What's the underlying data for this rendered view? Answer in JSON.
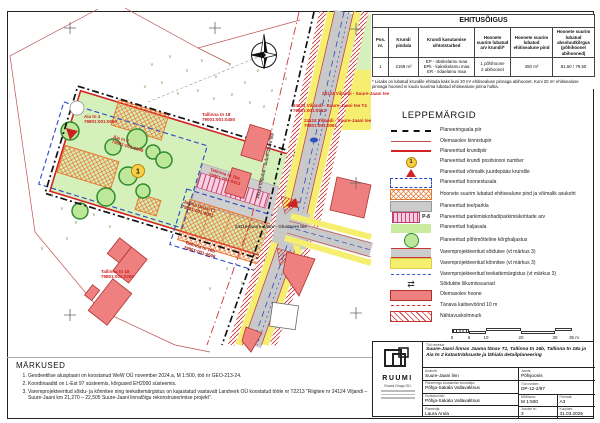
{
  "ehitusoigus": {
    "title": "EHITUSÕIGUS",
    "headers": [
      "Pos. nr.",
      "Krundi pindala",
      "Krundi kasutamise sihtotstarbed",
      "Hoonete suurim lubatud arv krundil*",
      "Hoonete suurim lubatud ehitisealune pind",
      "Hoonete suurim lubatud absoluutkõrgus (põhihoone/ abihooned)"
    ],
    "row": {
      "pos": "1",
      "area": "2169 m²",
      "purpose": "EP - üksikelamu maa\nEPk - kaksikelamu maa\nER - ridaelamu maa",
      "count": "1 põhihoone\n2 abihoonet",
      "footprint": "450 m²",
      "height": "81,50 / 79,50"
    },
    "footnote": "* Lisaks on lubatud krundile ehitada kaks kuni 20 m² ehitisealuse pinnaga abihoonet. Kuni 20 m² ehitisealuse pinnaga hooned ei kuulu suurima lubatud ehitisealuse pinna hulka."
  },
  "legend": {
    "title": "LEPPEMÄRGID",
    "items": [
      {
        "label": "Planeeringuala piir"
      },
      {
        "label": "Olemasolev kinnistupiir"
      },
      {
        "label": "Planeeritud krundipiir"
      },
      {
        "label": "Planeeritud krundi positsiooni number",
        "glyph": "1"
      },
      {
        "label": "Planeeritud võimalik juurdepääs krundile"
      },
      {
        "label": "Planeeritud hoonestusala"
      },
      {
        "label": "Hoonete suurim lubatud ehitisealune pind ja võimalik asukoht"
      },
      {
        "label": "Planeeritud tee/parkla"
      },
      {
        "label": "Planeeritud parkimiskohad/parkimiskohtade arv",
        "glyph": "P-8"
      },
      {
        "label": "Planeeritud haljasala"
      },
      {
        "label": "Planeeritud põhimõtteline kõrghaljastus"
      },
      {
        "label": "Varemprojekteeritud sõidutee (vt märkus 3)"
      },
      {
        "label": "Varemprojekteeritud kõnnitee (vt märkus 3)"
      },
      {
        "label": "Varemprojekteeritud teekattemärgistus (vt märkus 3)"
      },
      {
        "label": "Sõidukite liikumissuunad",
        "glyph": "⇄"
      },
      {
        "label": "Olemasolev hoone"
      },
      {
        "label": "Tänava kaitsevöönd 10 m"
      },
      {
        "label": "Nähtavuskolmnurk"
      }
    ]
  },
  "scalebar": {
    "labels": [
      "0",
      "5",
      "10",
      "20",
      "30",
      "35 m"
    ]
  },
  "notes": {
    "title": "MÄRKUSED",
    "items": [
      "Geodeetilise alusplaani on koostanud WeW OÜ november 2024.a, M 1:500, töö nr GEO-213-24.",
      "Koordinaadid on L-Est 97 süsteemis, kõrgused EH2000 süsteemis.",
      "Varemprojekteeritud sõidu- ja kõnnitee ning teekattemärgistus on kajastatud vastavalt Landverk OÜ koostatud tööle nr T2213 \"Riigitee nr 24124 Viljandi – Suure-Jaani km 21,270 – 22,505 Suure-Jaani linnalõigu rekonstrueerimise projekt\"."
    ]
  },
  "titleblock": {
    "logo_text": "RUUMI",
    "company": "Ruumi Grupp OÜ",
    "project_label": "Töö nimetus:",
    "project": "Suure-Jaani linnas Jaama tänav T1, Tallinna tn 16b, Tallinna tn 18a ja Aia tn 2 katastriüksuste ja lähiala detailplaneering",
    "location_label": "Asukoht:",
    "location": "Suure-Jaani linn",
    "organizer_label": "Planeeringu koostamise korraldaja:",
    "organizer": "Põhja-Sakala Vallavalitsus",
    "interested_label": "Huvitatud isik:",
    "interested": "Põhja-Sakala Vallavalitsus",
    "planner_label": "Planeerija:",
    "planner": "Laura Arula",
    "drawing_label": "Joonis:",
    "drawing": "Põhijoonis",
    "number_label": "Töö number:",
    "number": "DP-12-2/97",
    "scale_label": "Mõõtkava:",
    "scale": "M 1:500",
    "format_label": "Formaat:",
    "format": "A3",
    "sheet_label": "Joonise nr:",
    "sheet": "3",
    "date_label": "Kuupäev:",
    "date": "31.03.2025"
  },
  "map": {
    "pos_number": "1",
    "grass_glyph": "∨",
    "labels": [
      {
        "text": "Aia tn 4\n79801:001:0050"
      },
      {
        "text": "Aia tn 2\n79801:001:0049"
      },
      {
        "text": "Tallinna tn 18\n79001:001:0450"
      },
      {
        "text": "Tallinna tn 18\n79801:001:0280"
      },
      {
        "text": "Jaama tänav T1\n79801:001:0001"
      },
      {
        "text": "Tallinna tn 16b\n79801:001:0506"
      },
      {
        "text": "Tallinna tn 16a\n79801:001:0413"
      },
      {
        "text": "24124 Viljandi - Suure-Jaani tee T4\n79801:001:0012"
      },
      {
        "text": "24124 Viljandi - Suure-Jaani tee\n79801:001:0061"
      },
      {
        "text": "24124 Viljandi - Suure-Jaani tee"
      },
      {
        "text": "24116 Suure-Jaani - Olustvere tee"
      },
      {
        "text": "24124 Viljandi - Suure-Jaani tee"
      }
    ]
  },
  "colors": {
    "parcel_green": "#d6f0bc",
    "road_gray": "#c9c9c9",
    "sidewalk_yellow": "#f6ee6e",
    "building_red": "#ef8080",
    "boundary_red": "#cc3333",
    "footprint_orange": "#e8762c",
    "hoonestusala_blue": "#2b49c4",
    "pos_circle_yellow": "#f7d046"
  }
}
